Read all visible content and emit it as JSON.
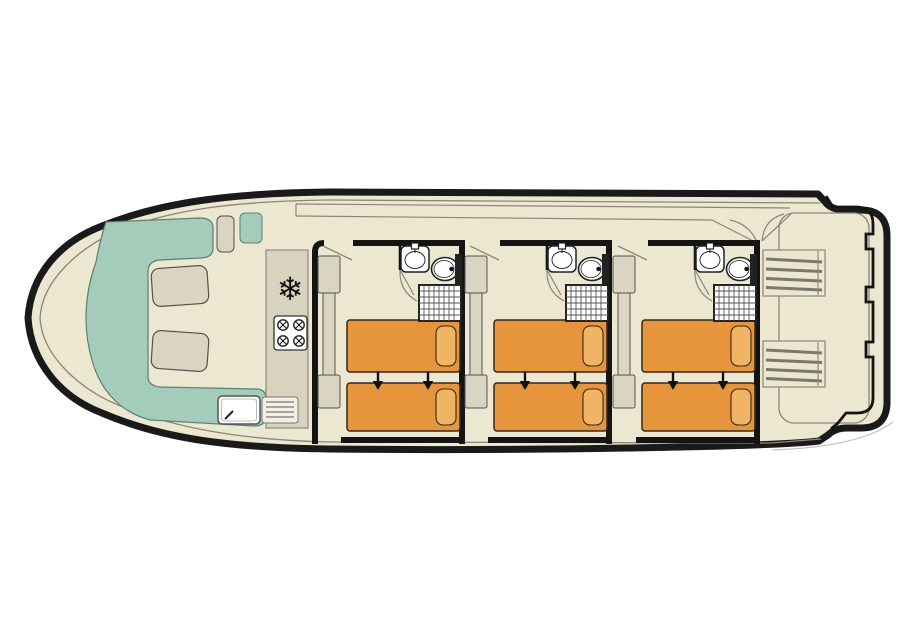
{
  "meta": {
    "description": "houseboat deck floor plan, bow on left, stern with stairs on right"
  },
  "colors": {
    "hull": "#1a1a1a",
    "deck": "#ece7d1",
    "lounge": "#a3cdba",
    "furniture": "#dad4c2",
    "counter": "#d8d2bf",
    "bed": "#e6953c",
    "pillow": "#f1b464",
    "wall": "#141414",
    "thin": "#8b8677",
    "fixture": "#222222",
    "white": "#ffffff"
  },
  "bow_lounge": {
    "bench_shape": "U",
    "cushion_count": 2
  },
  "galley": {
    "icons": [
      "freezer-snowflake-icon",
      "stove-four-burner-icon",
      "sink-drainer-icon"
    ],
    "freezer_glyph": "❄",
    "burner_count": 4
  },
  "cabins": {
    "count": 3,
    "each": {
      "beds": 2,
      "bed_join_arrows": 2,
      "wardrobe_blocks": 3,
      "ensuite": [
        "washbasin-icon",
        "toilet-icon",
        "shower-icon"
      ]
    }
  },
  "stern": {
    "stair_units": 2,
    "treads_per_stair": 4,
    "bulwark_notches": 3
  }
}
